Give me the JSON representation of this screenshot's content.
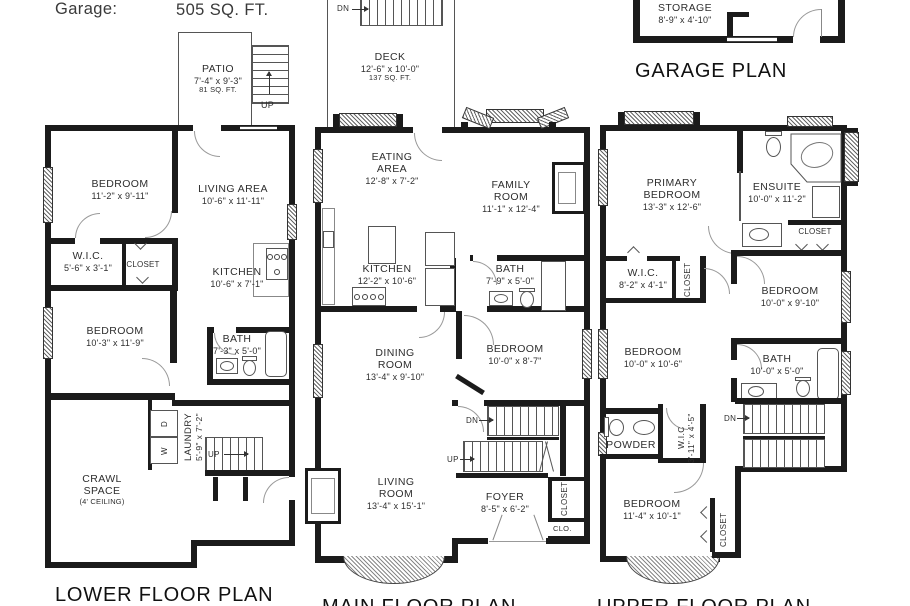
{
  "colors": {
    "wall": "#1b1b1b",
    "background": "#ffffff",
    "text": "#2e2e2e"
  },
  "header": {
    "garage_label": "Garage:",
    "garage_sqft": "505 SQ. FT."
  },
  "titles": {
    "lower": "LOWER FLOOR PLAN",
    "main": "MAIN FLOOR PLAN",
    "upper": "UPPER FLOOR PLAN",
    "garage": "GARAGE PLAN"
  },
  "outdoor": {
    "patio": {
      "name": "PATIO",
      "dims": "7'-4\" x 9'-3\"",
      "note": "81 SQ. FT.",
      "up": "UP"
    },
    "deck": {
      "name": "DECK",
      "dims": "12'-6\" x 10'-0\"",
      "note": "137 SQ. FT.",
      "dn": "DN"
    }
  },
  "garage": {
    "storage": {
      "name": "STORAGE",
      "dims": "8'-9\" x 4'-10\""
    }
  },
  "lower": {
    "bedroom1": {
      "name": "BEDROOM",
      "dims": "11'-2\" x 9'-11\""
    },
    "living": {
      "name": "LIVING AREA",
      "dims": "10'-6\" x 11'-11\""
    },
    "wic": {
      "name": "W.I.C.",
      "dims": "5'-6\" x 3'-1\""
    },
    "closet": "CLOSET",
    "kitchen": {
      "name": "KITCHEN",
      "dims": "10'-6\" x 7'-1\""
    },
    "bedroom2": {
      "name": "BEDROOM",
      "dims": "10'-3\" x 11'-9\""
    },
    "bath": {
      "name": "BATH",
      "dims": "7'-3\" x 5'-0\""
    },
    "laundry": {
      "name": "LAUNDRY",
      "dims": "5'-9\" x 7'-2\""
    },
    "crawl": {
      "line1": "CRAWL",
      "line2": "SPACE",
      "note": "(4' CEILING)"
    },
    "washer": "W",
    "dryer": "D",
    "up": "UP"
  },
  "main": {
    "eating": {
      "name": "EATING AREA",
      "dims": "12'-8\" x 7'-2\""
    },
    "family": {
      "name": "FAMILY ROOM",
      "dims": "11'-1\" x 12'-4\""
    },
    "kitchen": {
      "name": "KITCHEN",
      "dims": "12'-2\" x 10'-6\""
    },
    "bath": {
      "name": "BATH",
      "dims": "7'-9\" x 5'-0\""
    },
    "dining": {
      "name": "DINING ROOM",
      "dims": "13'-4\" x 9'-10\""
    },
    "bedroom": {
      "name": "BEDROOM",
      "dims": "10'-0\" x 8'-7\""
    },
    "living": {
      "name": "LIVING ROOM",
      "dims": "13'-4\" x 15'-1\""
    },
    "foyer": {
      "name": "FOYER",
      "dims": "8'-5\" x 6'-2\""
    },
    "closet": "CLOSET",
    "clo": "CLO.",
    "dn": "DN",
    "up": "UP"
  },
  "upper": {
    "primary": {
      "line1": "PRIMARY",
      "line2": "BEDROOM",
      "dims": "13'-3\" x 12'-6\""
    },
    "ensuite": {
      "name": "ENSUITE",
      "dims": "10'-0\" x 11'-2\""
    },
    "closet1": "CLOSET",
    "wic1": {
      "name": "W.I.C.",
      "dims": "8'-2\" x 4'-1\""
    },
    "closet2": "CLOSET",
    "bedroom1": {
      "name": "BEDROOM",
      "dims": "10'-0\" x 9'-10\""
    },
    "bedroom2": {
      "name": "BEDROOM",
      "dims": "10'-0\" x 10'-6\""
    },
    "bath": {
      "name": "BATH",
      "dims": "10'-0\" x 5'-0\""
    },
    "powder": "POWDER",
    "wic2": {
      "name": "W.I.C",
      "dims": "3'-11\" x 4'-5\""
    },
    "bedroom3": {
      "name": "BEDROOM",
      "dims": "11'-4\" x 10'-1\""
    },
    "closet3": "CLOSET",
    "dn": "DN"
  }
}
